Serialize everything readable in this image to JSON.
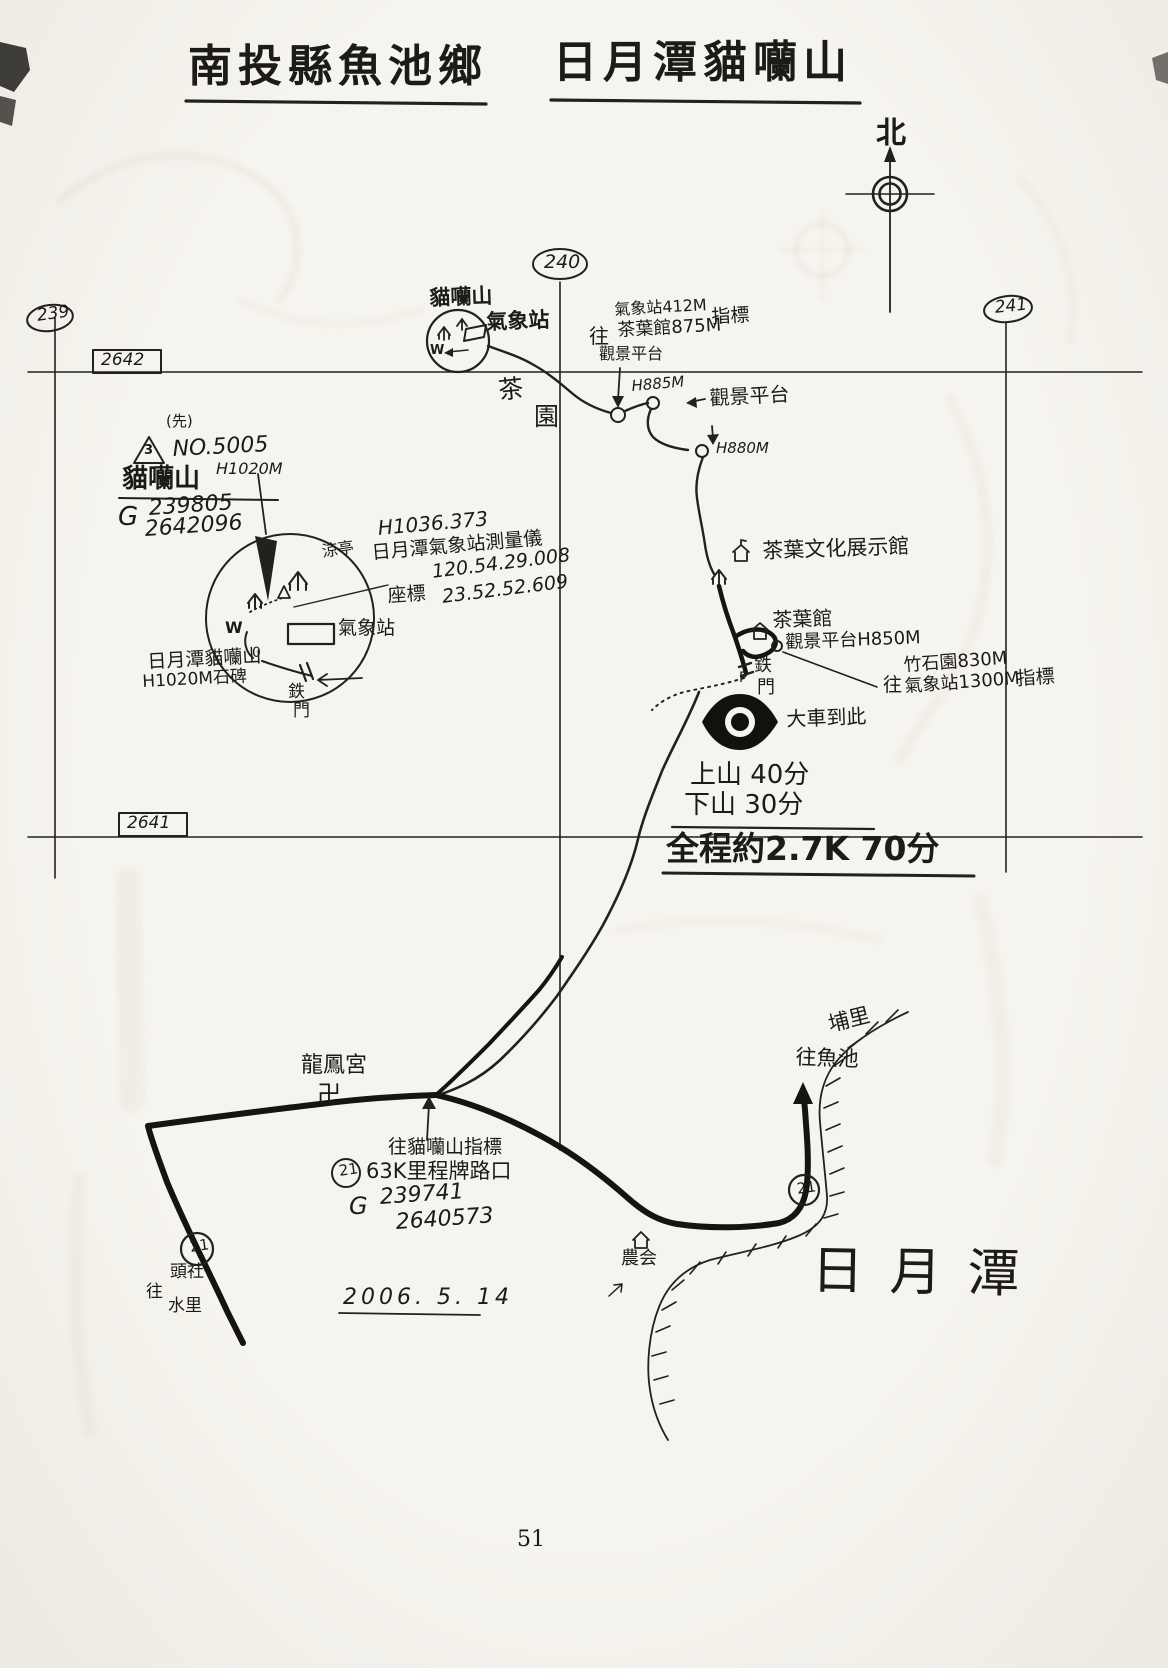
{
  "page": {
    "number": "51",
    "date": "2006. 5. 14"
  },
  "header": {
    "title_left": "南投縣魚池鄉",
    "title_right": "日月潭貓囒山"
  },
  "compass": {
    "north": "北"
  },
  "grid": {
    "ovals": {
      "o239": "239",
      "o240": "240",
      "o241": "241"
    },
    "boxes": {
      "b2642": "2642",
      "b2641": "2641"
    }
  },
  "station": {
    "name_line1": "貓囒山",
    "name_line2": "氣象站",
    "w": "W",
    "tea_char1": "茶",
    "tea_char2": "園"
  },
  "signpost_station": {
    "to": "往",
    "line1": "氣象站412M",
    "line2": "茶葉館875M",
    "suffix": "指標",
    "line3": "觀景平台"
  },
  "spots": {
    "h885": "H885M",
    "view_platform": "觀景平台",
    "h880": "H880M"
  },
  "summit": {
    "class_note": "(先)",
    "triangle_num": "3",
    "point_no": "NO.5005",
    "name": "貓囒山",
    "elev": "H1020M",
    "g": "G",
    "coord1": "239805",
    "coord2": "2642096"
  },
  "survey": {
    "elev": "H1036.373",
    "station_note": "日月潭氣象站測量儀",
    "coord_label": "座標",
    "coord1": "120.54.29.008",
    "coord2": "23.52.52.609"
  },
  "inset": {
    "pavilion": "涼亭",
    "station": "氣象站",
    "w": "W",
    "o": "0",
    "gate_char1": "鉄",
    "gate_char2": "門",
    "stone_line1": "日月潭貓囒山",
    "stone_line2": "H1020M石碑"
  },
  "tea_area": {
    "exhibit_hall": "茶葉文化展示館",
    "tea_house": "茶葉館",
    "view_platform": "觀景平台H850M",
    "gate_char1": "鉄",
    "gate_char2": "門",
    "gate_p": "P",
    "car_note": "大車到此"
  },
  "signpost_garden": {
    "to": "往",
    "line1": "竹石園830M",
    "line2": "氣象站1300M",
    "suffix": "指標"
  },
  "times": {
    "up": "上山 40分",
    "down": "下山 30分",
    "total": "全程約2.7K 70分"
  },
  "junction": {
    "temple": "龍鳳宮",
    "swastika": "卍",
    "note1": "往貓囒山指標",
    "badge": "21",
    "note2": "63K里程牌路口",
    "g": "G",
    "coord1": "239741",
    "coord2": "2640573"
  },
  "roads": {
    "badge_west": "21",
    "badge_east": "21",
    "puli": "埔里",
    "to_yuchi": "往魚池",
    "to_tousha_pre": "往",
    "to_tousha1": "頭社",
    "to_tousha2": "水里",
    "farmers_assoc": "農会"
  },
  "lake": {
    "name": "日月潭"
  },
  "icons": {
    "north_compass": "⊕",
    "pavilion": "个",
    "house": "⌂",
    "eye_viewpoint": "◉",
    "benchmark": "△"
  },
  "colors": {
    "paper": "#f6f4ee",
    "ink": "#23211d",
    "road_ink": "#16140f"
  }
}
